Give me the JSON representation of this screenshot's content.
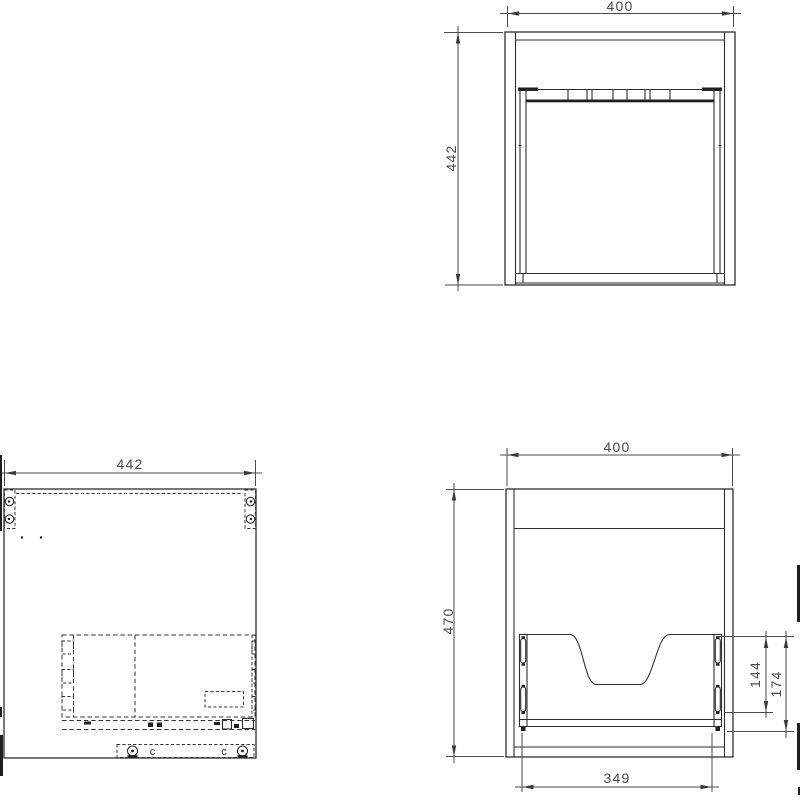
{
  "drawing": {
    "background": "#ffffff",
    "line_color": "#2e2e2e",
    "dimension_color": "#4a4a4a",
    "views": {
      "plan": {
        "width": "400",
        "depth": "442"
      },
      "side": {
        "width": "442",
        "fitting_mark": "c"
      },
      "front": {
        "width": "400",
        "height": "470",
        "drawer_width": "349",
        "cutout_height": "144",
        "back_panel_height": "174"
      }
    }
  }
}
